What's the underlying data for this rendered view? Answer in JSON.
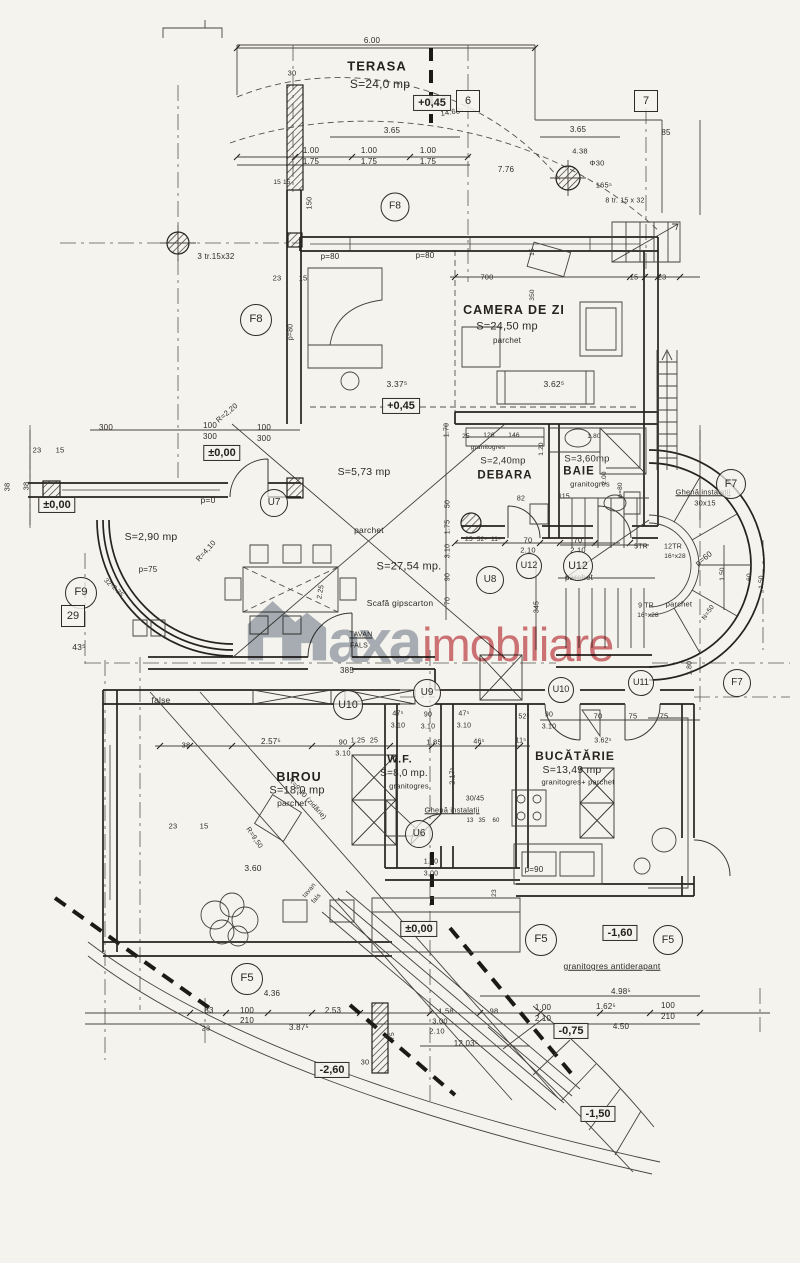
{
  "watermark": {
    "text_gray": "axa",
    "text_red": "imobiliare",
    "gray_hex": "#97a0ac",
    "red_hex": "#c84f55"
  },
  "plan": {
    "levels": [
      {
        "t": "+0,45",
        "x": 432,
        "y": 103
      },
      {
        "t": "+0,45",
        "x": 401,
        "y": 406
      },
      {
        "t": "±0,00",
        "x": 222,
        "y": 453
      },
      {
        "t": "±0,00",
        "x": 57,
        "y": 505
      },
      {
        "t": "±0,00",
        "x": 419,
        "y": 929
      },
      {
        "t": "-0,75",
        "x": 571,
        "y": 1031
      },
      {
        "t": "-1,60",
        "x": 620,
        "y": 933
      },
      {
        "t": "-1,50",
        "x": 598,
        "y": 1114
      },
      {
        "t": "-2,60",
        "x": 332,
        "y": 1070
      }
    ],
    "square_tags": [
      {
        "t": "6",
        "x": 468,
        "y": 101
      },
      {
        "t": "7",
        "x": 646,
        "y": 101
      },
      {
        "t": "29",
        "x": 73,
        "y": 616
      }
    ],
    "ring_tags": [
      {
        "t": "F8",
        "x": 395,
        "y": 207,
        "d": 27
      },
      {
        "t": "F8",
        "x": 256,
        "y": 320,
        "d": 30
      },
      {
        "t": "F9",
        "x": 81,
        "y": 593,
        "d": 30
      },
      {
        "t": "F7",
        "x": 731,
        "y": 484,
        "d": 28
      },
      {
        "t": "F7",
        "x": 737,
        "y": 683,
        "d": 26
      },
      {
        "t": "F5",
        "x": 541,
        "y": 940,
        "d": 30
      },
      {
        "t": "F5",
        "x": 668,
        "y": 940,
        "d": 28
      },
      {
        "t": "F5",
        "x": 247,
        "y": 979,
        "d": 30
      },
      {
        "t": "U7",
        "x": 274,
        "y": 503,
        "d": 26
      },
      {
        "t": "U8",
        "x": 490,
        "y": 580,
        "d": 26
      },
      {
        "t": "U9",
        "x": 427,
        "y": 693,
        "d": 26
      },
      {
        "t": "U10",
        "x": 348,
        "y": 705,
        "d": 28
      },
      {
        "t": "U10",
        "x": 561,
        "y": 690,
        "d": 24
      },
      {
        "t": "U11",
        "x": 641,
        "y": 683,
        "d": 24
      },
      {
        "t": "U12",
        "x": 529,
        "y": 566,
        "d": 24
      },
      {
        "t": "U12",
        "x": 578,
        "y": 566,
        "d": 28
      },
      {
        "t": "U6",
        "x": 419,
        "y": 834,
        "d": 26
      }
    ],
    "labels": [
      {
        "t": "6.00",
        "x": 372,
        "y": 41
      },
      {
        "t": "TERASA",
        "x": 377,
        "y": 66,
        "s": 13,
        "n": "room-label",
        "c": "room"
      },
      {
        "t": "S=24,0 mp",
        "x": 380,
        "y": 84,
        "s": 12
      },
      {
        "t": "30",
        "x": 292,
        "y": 73,
        "s": 7.5
      },
      {
        "t": "14.68⁵",
        "x": 452,
        "y": 112,
        "s": 7.5,
        "r": -8
      },
      {
        "t": "3.65",
        "x": 392,
        "y": 131,
        "s": 8
      },
      {
        "t": "3.65",
        "x": 578,
        "y": 130,
        "s": 8
      },
      {
        "t": "85",
        "x": 666,
        "y": 133,
        "s": 8
      },
      {
        "t": "1.00",
        "x": 311,
        "y": 151,
        "s": 8
      },
      {
        "t": "1.75",
        "x": 311,
        "y": 162,
        "s": 8
      },
      {
        "t": "1.00",
        "x": 369,
        "y": 151,
        "s": 8
      },
      {
        "t": "1.75",
        "x": 369,
        "y": 162,
        "s": 8
      },
      {
        "t": "1.00",
        "x": 428,
        "y": 151,
        "s": 8
      },
      {
        "t": "1.75",
        "x": 428,
        "y": 162,
        "s": 8
      },
      {
        "t": "7.76",
        "x": 506,
        "y": 170,
        "s": 8
      },
      {
        "t": "4.38",
        "x": 580,
        "y": 151,
        "s": 7.5
      },
      {
        "t": "Φ30",
        "x": 597,
        "y": 163,
        "s": 7.5
      },
      {
        "t": "165⁵",
        "x": 604,
        "y": 185,
        "s": 7.5
      },
      {
        "t": "8 tr. 15 x 32",
        "x": 625,
        "y": 201,
        "s": 7
      },
      {
        "t": "15 15",
        "x": 282,
        "y": 183,
        "s": 6.5
      },
      {
        "t": "150",
        "x": 309,
        "y": 203,
        "s": 7.5,
        "r": -90
      },
      {
        "t": "3 tr.15x32",
        "x": 216,
        "y": 257,
        "s": 8
      },
      {
        "t": "23",
        "x": 277,
        "y": 278,
        "s": 7.5
      },
      {
        "t": "15",
        "x": 303,
        "y": 278,
        "s": 7.5
      },
      {
        "t": "p=80",
        "x": 330,
        "y": 257,
        "s": 8
      },
      {
        "t": "p=80",
        "x": 425,
        "y": 256,
        "s": 8
      },
      {
        "t": "p=80",
        "x": 291,
        "y": 332,
        "s": 7,
        "r": -90
      },
      {
        "t": "700",
        "x": 487,
        "y": 277,
        "s": 7.5
      },
      {
        "t": "15",
        "x": 634,
        "y": 277,
        "s": 7.5
      },
      {
        "t": "23",
        "x": 662,
        "y": 277,
        "s": 7.5
      },
      {
        "t": "15",
        "x": 533,
        "y": 252,
        "s": 6.5,
        "r": -90
      },
      {
        "t": "350",
        "x": 533,
        "y": 295,
        "s": 6.5,
        "r": -90
      },
      {
        "t": "CAMERA DE ZI",
        "x": 514,
        "y": 310,
        "s": 12.5,
        "n": "room-label",
        "c": "room"
      },
      {
        "t": "S=24,50 mp",
        "x": 507,
        "y": 327,
        "s": 11
      },
      {
        "t": "parchet",
        "x": 507,
        "y": 341,
        "s": 8
      },
      {
        "t": "3.62⁵",
        "x": 554,
        "y": 384,
        "s": 8.5
      },
      {
        "t": "3.37⁵",
        "x": 397,
        "y": 384,
        "s": 8.5
      },
      {
        "t": "R=2,20",
        "x": 227,
        "y": 413,
        "s": 7.5,
        "r": -40
      },
      {
        "t": "300",
        "x": 106,
        "y": 428,
        "s": 8
      },
      {
        "t": "100",
        "x": 210,
        "y": 426,
        "s": 8
      },
      {
        "t": "300",
        "x": 210,
        "y": 437,
        "s": 8
      },
      {
        "t": "100",
        "x": 264,
        "y": 428,
        "s": 8
      },
      {
        "t": "300",
        "x": 264,
        "y": 439,
        "s": 8
      },
      {
        "t": "23",
        "x": 37,
        "y": 450,
        "s": 7.5
      },
      {
        "t": "15",
        "x": 60,
        "y": 450,
        "s": 7.5
      },
      {
        "t": "38",
        "x": 7,
        "y": 487,
        "s": 7.5,
        "r": -90
      },
      {
        "t": "38",
        "x": 26,
        "y": 486,
        "s": 7.5,
        "r": -90
      },
      {
        "t": "S=5,73 mp",
        "x": 364,
        "y": 472,
        "s": 10.5
      },
      {
        "t": "p=0",
        "x": 208,
        "y": 500,
        "s": 8.5
      },
      {
        "t": "S=2,90 mp",
        "x": 151,
        "y": 537,
        "s": 10.5
      },
      {
        "t": "p=75",
        "x": 148,
        "y": 570,
        "s": 8
      },
      {
        "t": "parchet",
        "x": 369,
        "y": 530,
        "s": 8.5
      },
      {
        "t": "S=27,54 mp.",
        "x": 409,
        "y": 567,
        "s": 11
      },
      {
        "t": "R=4,10",
        "x": 206,
        "y": 551,
        "s": 7.5,
        "r": -48
      },
      {
        "t": "Scafă gipscarton",
        "x": 400,
        "y": 603,
        "s": 8.5
      },
      {
        "t": "TAVAN",
        "x": 361,
        "y": 635,
        "s": 7,
        "u": 1
      },
      {
        "t": "FALS",
        "x": 359,
        "y": 646,
        "s": 7
      },
      {
        "t": "385",
        "x": 347,
        "y": 671,
        "s": 8
      },
      {
        "t": "1.70",
        "x": 447,
        "y": 430,
        "s": 7,
        "r": -90
      },
      {
        "t": "50",
        "x": 448,
        "y": 504,
        "s": 7,
        "r": -90
      },
      {
        "t": "1.75",
        "x": 448,
        "y": 527,
        "s": 7,
        "r": -90
      },
      {
        "t": "3.10",
        "x": 448,
        "y": 551,
        "s": 7,
        "r": -90
      },
      {
        "t": "90",
        "x": 448,
        "y": 577,
        "s": 7,
        "r": -90
      },
      {
        "t": "70",
        "x": 448,
        "y": 601,
        "s": 7,
        "r": -90
      },
      {
        "t": "32⁵",
        "x": 108,
        "y": 584,
        "s": 6.5,
        "r": 45
      },
      {
        "t": "2.25",
        "x": 117,
        "y": 592,
        "s": 6.5,
        "r": 45
      },
      {
        "t": "43⁵",
        "x": 79,
        "y": 647,
        "s": 8.5
      },
      {
        "t": "2.25",
        "x": 321,
        "y": 592,
        "s": 7,
        "r": -80
      },
      {
        "t": "25",
        "x": 469,
        "y": 540,
        "s": 6.5
      },
      {
        "t": "52⁵",
        "x": 482,
        "y": 540,
        "s": 6.5
      },
      {
        "t": "11⁵",
        "x": 496,
        "y": 540,
        "s": 6.5
      },
      {
        "t": "70",
        "x": 528,
        "y": 540,
        "s": 7.5
      },
      {
        "t": "2.10",
        "x": 528,
        "y": 550,
        "s": 7.5
      },
      {
        "t": "70",
        "x": 578,
        "y": 540,
        "s": 7.5
      },
      {
        "t": "2.10",
        "x": 578,
        "y": 550,
        "s": 7.5
      },
      {
        "t": "345",
        "x": 537,
        "y": 607,
        "s": 7,
        "r": -90
      },
      {
        "t": "parchet",
        "x": 579,
        "y": 578,
        "s": 8
      },
      {
        "t": "126",
        "x": 489,
        "y": 436,
        "s": 6.5
      },
      {
        "t": "146",
        "x": 514,
        "y": 436,
        "s": 6.5
      },
      {
        "t": "25",
        "x": 466,
        "y": 437,
        "s": 6.5
      },
      {
        "t": "granitogres",
        "x": 488,
        "y": 448,
        "s": 6.5
      },
      {
        "t": "S=2,40mp",
        "x": 503,
        "y": 461,
        "s": 9.5
      },
      {
        "t": "DEBARA",
        "x": 505,
        "y": 476,
        "s": 11.5,
        "n": "room-label",
        "c": "room"
      },
      {
        "t": "1.20",
        "x": 542,
        "y": 449,
        "s": 6.5,
        "r": -90
      },
      {
        "t": "82",
        "x": 521,
        "y": 499,
        "s": 7
      },
      {
        "t": "115",
        "x": 564,
        "y": 497,
        "s": 7
      },
      {
        "t": "1.80",
        "x": 594,
        "y": 437,
        "s": 6.5
      },
      {
        "t": "S=3,60mp",
        "x": 587,
        "y": 459,
        "s": 9.5
      },
      {
        "t": "BAIE",
        "x": 579,
        "y": 472,
        "s": 11.5,
        "n": "room-label",
        "c": "room"
      },
      {
        "t": "granitogres",
        "x": 590,
        "y": 484,
        "s": 7.5
      },
      {
        "t": "2.00",
        "x": 605,
        "y": 478,
        "s": 6.5,
        "r": -90
      },
      {
        "t": "p=80",
        "x": 621,
        "y": 490,
        "s": 6.5,
        "r": -90
      },
      {
        "t": "Ghenă instalații",
        "x": 703,
        "y": 492,
        "s": 7.5,
        "u": 1
      },
      {
        "t": "30x15",
        "x": 705,
        "y": 503,
        "s": 7.5
      },
      {
        "t": "p=60",
        "x": 704,
        "y": 559,
        "s": 8,
        "r": -38
      },
      {
        "t": "5TR",
        "x": 641,
        "y": 547,
        "s": 7
      },
      {
        "t": "12TR",
        "x": 673,
        "y": 547,
        "s": 7
      },
      {
        "t": "16⁵x28",
        "x": 675,
        "y": 557,
        "s": 6.5
      },
      {
        "t": "9 TR",
        "x": 646,
        "y": 606,
        "s": 7
      },
      {
        "t": "16⁵x28",
        "x": 648,
        "y": 616,
        "s": 6.5
      },
      {
        "t": "parchet",
        "x": 679,
        "y": 604,
        "s": 7.5
      },
      {
        "t": "1.50",
        "x": 723,
        "y": 574,
        "s": 6.5,
        "r": -90
      },
      {
        "t": "60",
        "x": 750,
        "y": 577,
        "s": 6.5,
        "r": -90
      },
      {
        "t": "1.50",
        "x": 762,
        "y": 582,
        "s": 6.5,
        "r": -90
      },
      {
        "t": "N=50",
        "x": 709,
        "y": 613,
        "s": 6.5,
        "r": -55
      },
      {
        "t": "false",
        "x": 161,
        "y": 700,
        "s": 8.5
      },
      {
        "t": "38",
        "x": 186,
        "y": 745,
        "s": 7.5
      },
      {
        "t": "2.57⁵",
        "x": 271,
        "y": 742,
        "s": 8
      },
      {
        "t": "90",
        "x": 343,
        "y": 742,
        "s": 7.5
      },
      {
        "t": "3.10",
        "x": 343,
        "y": 753,
        "s": 7.5
      },
      {
        "t": "1.25",
        "x": 358,
        "y": 741,
        "s": 7
      },
      {
        "t": "25",
        "x": 374,
        "y": 741,
        "s": 7
      },
      {
        "t": "47⁵",
        "x": 398,
        "y": 714,
        "s": 7
      },
      {
        "t": "3.10",
        "x": 398,
        "y": 726,
        "s": 7
      },
      {
        "t": "90",
        "x": 428,
        "y": 715,
        "s": 7
      },
      {
        "t": "3.10",
        "x": 428,
        "y": 727,
        "s": 7
      },
      {
        "t": "47⁵",
        "x": 464,
        "y": 714,
        "s": 7
      },
      {
        "t": "3.10",
        "x": 464,
        "y": 726,
        "s": 7
      },
      {
        "t": "1.85",
        "x": 434,
        "y": 742,
        "s": 7.5
      },
      {
        "t": "46⁵",
        "x": 479,
        "y": 742,
        "s": 7
      },
      {
        "t": "11⁵",
        "x": 521,
        "y": 741,
        "s": 7
      },
      {
        "t": "52⁵",
        "x": 524,
        "y": 717,
        "s": 7
      },
      {
        "t": "90",
        "x": 549,
        "y": 715,
        "s": 7
      },
      {
        "t": "3.10",
        "x": 549,
        "y": 727,
        "s": 7
      },
      {
        "t": "70",
        "x": 598,
        "y": 716,
        "s": 7.5
      },
      {
        "t": "75",
        "x": 633,
        "y": 716,
        "s": 7.5
      },
      {
        "t": "75",
        "x": 664,
        "y": 716,
        "s": 7.5
      },
      {
        "t": "1.80",
        "x": 690,
        "y": 668,
        "s": 7,
        "r": -90
      },
      {
        "t": "3.62⁵",
        "x": 603,
        "y": 741,
        "s": 7
      },
      {
        "t": "W.F.",
        "x": 400,
        "y": 760,
        "s": 11,
        "n": "room-label",
        "c": "room"
      },
      {
        "t": "S=8,0 mp.",
        "x": 404,
        "y": 774,
        "s": 10
      },
      {
        "t": "granitogres",
        "x": 409,
        "y": 786,
        "s": 7.5
      },
      {
        "t": "2.17⁵",
        "x": 453,
        "y": 776,
        "s": 7,
        "r": -90
      },
      {
        "t": "BUCĂTĂRIE",
        "x": 575,
        "y": 756,
        "s": 12,
        "n": "room-label",
        "c": "room"
      },
      {
        "t": "S=13,49 mp",
        "x": 572,
        "y": 770,
        "s": 10.5
      },
      {
        "t": "granitogres+ parchet",
        "x": 578,
        "y": 782,
        "s": 7.5
      },
      {
        "t": "30/45",
        "x": 475,
        "y": 799,
        "s": 7
      },
      {
        "t": "Ghenă instalații",
        "x": 452,
        "y": 810,
        "s": 7.5,
        "u": 1
      },
      {
        "t": "13",
        "x": 470,
        "y": 821,
        "s": 6
      },
      {
        "t": "35",
        "x": 482,
        "y": 821,
        "s": 6
      },
      {
        "t": "60",
        "x": 496,
        "y": 821,
        "s": 6
      },
      {
        "t": "BIROU",
        "x": 299,
        "y": 777,
        "s": 12.5,
        "n": "room-label",
        "c": "room"
      },
      {
        "t": "S=18,0 mp",
        "x": 297,
        "y": 791,
        "s": 11
      },
      {
        "t": "parchet",
        "x": 292,
        "y": 803,
        "s": 8.5
      },
      {
        "t": "R=9,10 (zidărie)",
        "x": 307,
        "y": 799,
        "s": 7,
        "r": 48
      },
      {
        "t": "R=9,50",
        "x": 254,
        "y": 838,
        "s": 7,
        "r": 56
      },
      {
        "t": "23",
        "x": 173,
        "y": 826,
        "s": 7.5
      },
      {
        "t": "15",
        "x": 204,
        "y": 826,
        "s": 7.5
      },
      {
        "t": "3.60",
        "x": 253,
        "y": 868,
        "s": 8.5
      },
      {
        "t": "1.00",
        "x": 431,
        "y": 862,
        "s": 7
      },
      {
        "t": "3.00",
        "x": 431,
        "y": 874,
        "s": 7
      },
      {
        "t": "p=90",
        "x": 534,
        "y": 870,
        "s": 8
      },
      {
        "t": "tavan",
        "x": 310,
        "y": 891,
        "s": 6.5,
        "r": -50
      },
      {
        "t": "fals",
        "x": 317,
        "y": 899,
        "s": 6.5,
        "r": -50
      },
      {
        "t": "23",
        "x": 495,
        "y": 893,
        "s": 6.5,
        "r": -90
      },
      {
        "t": "granitogres antiderapant",
        "x": 612,
        "y": 966,
        "s": 8.5,
        "u": 1
      },
      {
        "t": "4.98⁵",
        "x": 621,
        "y": 992,
        "s": 8
      },
      {
        "t": "1.58",
        "x": 446,
        "y": 1011,
        "s": 7.5
      },
      {
        "t": "3.00",
        "x": 440,
        "y": 1021,
        "s": 7.5
      },
      {
        "t": "2.10",
        "x": 437,
        "y": 1031,
        "s": 7.5
      },
      {
        "t": "98",
        "x": 494,
        "y": 1011,
        "s": 7.5
      },
      {
        "t": "1.00",
        "x": 543,
        "y": 1008,
        "s": 8
      },
      {
        "t": "2.10",
        "x": 543,
        "y": 1019,
        "s": 8
      },
      {
        "t": "1.62⁵",
        "x": 606,
        "y": 1007,
        "s": 8
      },
      {
        "t": "100",
        "x": 668,
        "y": 1006,
        "s": 8
      },
      {
        "t": "210",
        "x": 668,
        "y": 1017,
        "s": 8
      },
      {
        "t": "4.50",
        "x": 621,
        "y": 1027,
        "s": 8
      },
      {
        "t": "12,03⁵",
        "x": 466,
        "y": 1044,
        "s": 8
      },
      {
        "t": "4.36",
        "x": 272,
        "y": 994,
        "s": 8
      },
      {
        "t": "83",
        "x": 209,
        "y": 1011,
        "s": 8
      },
      {
        "t": "100",
        "x": 247,
        "y": 1011,
        "s": 8
      },
      {
        "t": "210",
        "x": 247,
        "y": 1021,
        "s": 8
      },
      {
        "t": "2.53",
        "x": 333,
        "y": 1011,
        "s": 8
      },
      {
        "t": "23",
        "x": 206,
        "y": 1028,
        "s": 7.5
      },
      {
        "t": "3.87⁵",
        "x": 299,
        "y": 1028,
        "s": 8
      },
      {
        "t": "30",
        "x": 365,
        "y": 1062,
        "s": 7.5
      },
      {
        "t": "75",
        "x": 393,
        "y": 1036,
        "s": 6.5,
        "r": -90
      }
    ]
  }
}
